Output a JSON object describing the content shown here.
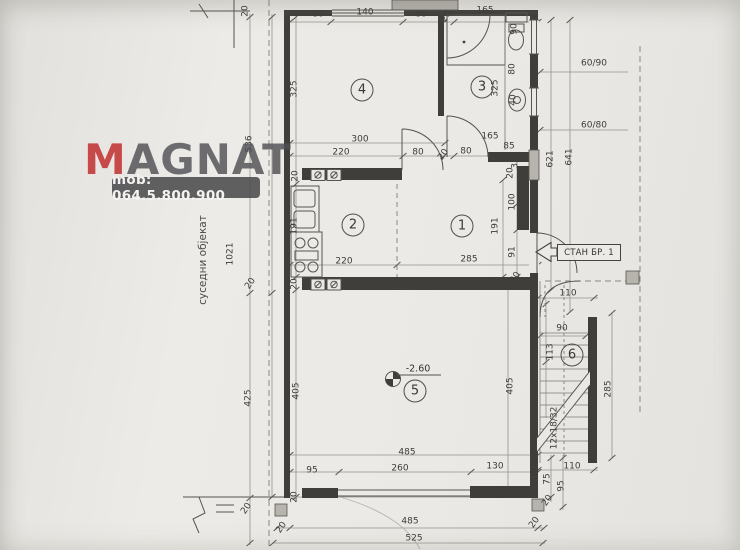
{
  "watermark": {
    "brand_m": "M",
    "brand_rest": "AGNAT",
    "phone": "mob: 064.5.800.900"
  },
  "labels": {
    "apartment_tag": "СТАН БР. 1",
    "neighbor_building": "суседни објекат",
    "elevation": "-2.60"
  },
  "rooms": [
    {
      "number": "1",
      "x": 462,
      "y": 226
    },
    {
      "number": "2",
      "x": 353,
      "y": 225
    },
    {
      "number": "3",
      "x": 482,
      "y": 87
    },
    {
      "number": "4",
      "x": 362,
      "y": 90
    },
    {
      "number": "5",
      "x": 415,
      "y": 391
    },
    {
      "number": "6",
      "x": 572,
      "y": 355
    }
  ],
  "dimensions": [
    {
      "text": "80",
      "x": 318,
      "y": 15
    },
    {
      "text": "140",
      "x": 365,
      "y": 13
    },
    {
      "text": "80",
      "x": 421,
      "y": 15
    },
    {
      "text": "20",
      "x": 447,
      "y": 17,
      "rot": -55
    },
    {
      "text": "165",
      "x": 485,
      "y": 11
    },
    {
      "text": "20",
      "x": 246,
      "y": 11,
      "rot": -90
    },
    {
      "text": "325",
      "x": 295,
      "y": 89,
      "rot": -90
    },
    {
      "text": "325",
      "x": 496,
      "y": 88,
      "rot": -90
    },
    {
      "text": "90",
      "x": 515,
      "y": 29,
      "rot": -90
    },
    {
      "text": "80",
      "x": 513,
      "y": 69,
      "rot": -90
    },
    {
      "text": "40",
      "x": 514,
      "y": 100,
      "rot": -90
    },
    {
      "text": "536",
      "x": 250,
      "y": 144,
      "rot": -90
    },
    {
      "text": "300",
      "x": 360,
      "y": 140
    },
    {
      "text": "220",
      "x": 341,
      "y": 153
    },
    {
      "text": "80",
      "x": 418,
      "y": 153
    },
    {
      "text": "20",
      "x": 444,
      "y": 155,
      "rot": -55
    },
    {
      "text": "80",
      "x": 466,
      "y": 152
    },
    {
      "text": "165",
      "x": 490,
      "y": 137
    },
    {
      "text": "85",
      "x": 509,
      "y": 147
    },
    {
      "text": "35",
      "x": 516,
      "y": 163,
      "rot": -90
    },
    {
      "text": "621",
      "x": 551,
      "y": 159,
      "rot": -90
    },
    {
      "text": "641",
      "x": 570,
      "y": 157,
      "rot": -90
    },
    {
      "text": "60/90",
      "x": 594,
      "y": 64
    },
    {
      "text": "60/80",
      "x": 594,
      "y": 126
    },
    {
      "text": "191",
      "x": 295,
      "y": 226,
      "rot": -90
    },
    {
      "text": "20",
      "x": 296,
      "y": 176,
      "rot": -90
    },
    {
      "text": "220",
      "x": 344,
      "y": 262
    },
    {
      "text": "285",
      "x": 469,
      "y": 260
    },
    {
      "text": "191",
      "x": 496,
      "y": 226,
      "rot": -90
    },
    {
      "text": "100",
      "x": 513,
      "y": 202,
      "rot": -90
    },
    {
      "text": "91",
      "x": 513,
      "y": 252,
      "rot": -90
    },
    {
      "text": "20",
      "x": 511,
      "y": 173,
      "rot": -90
    },
    {
      "text": "20",
      "x": 516,
      "y": 278,
      "rot": -55
    },
    {
      "text": "1021",
      "x": 231,
      "y": 254,
      "rot": -90
    },
    {
      "text": "20",
      "x": 251,
      "y": 284,
      "rot": -55
    },
    {
      "text": "20",
      "x": 295,
      "y": 284,
      "rot": -90
    },
    {
      "text": "425",
      "x": 249,
      "y": 398,
      "rot": -90
    },
    {
      "text": "405",
      "x": 297,
      "y": 391,
      "rot": -90
    },
    {
      "text": "405",
      "x": 511,
      "y": 386,
      "rot": -90
    },
    {
      "text": "110",
      "x": 568,
      "y": 294
    },
    {
      "text": "90",
      "x": 562,
      "y": 329
    },
    {
      "text": "113",
      "x": 551,
      "y": 352,
      "rot": -90
    },
    {
      "text": "285",
      "x": 609,
      "y": 389,
      "rot": -90
    },
    {
      "text": "12x18/32",
      "x": 555,
      "y": 428,
      "rot": -90
    },
    {
      "text": "485",
      "x": 407,
      "y": 453
    },
    {
      "text": "95",
      "x": 312,
      "y": 471
    },
    {
      "text": "260",
      "x": 400,
      "y": 469
    },
    {
      "text": "130",
      "x": 495,
      "y": 467
    },
    {
      "text": "20",
      "x": 295,
      "y": 497,
      "rot": -90
    },
    {
      "text": "75",
      "x": 548,
      "y": 479,
      "rot": -90
    },
    {
      "text": "95",
      "x": 562,
      "y": 486,
      "rot": -90
    },
    {
      "text": "110",
      "x": 572,
      "y": 467
    },
    {
      "text": "20",
      "x": 548,
      "y": 501,
      "rot": -55
    },
    {
      "text": "20",
      "x": 282,
      "y": 528,
      "rot": -55
    },
    {
      "text": "485",
      "x": 410,
      "y": 522
    },
    {
      "text": "20",
      "x": 535,
      "y": 523,
      "rot": -55
    },
    {
      "text": "525",
      "x": 414,
      "y": 539
    },
    {
      "text": "20",
      "x": 247,
      "y": 509,
      "rot": -55
    }
  ],
  "colors": {
    "paper": "#eae8e4",
    "line_dark": "#403e3a",
    "line_dim": "#95928b",
    "brand_red": "#c23434",
    "brand_gray": "#4f4f54",
    "banner_bg": "#4b4b4d",
    "banner_text": "#f4f3f1"
  }
}
